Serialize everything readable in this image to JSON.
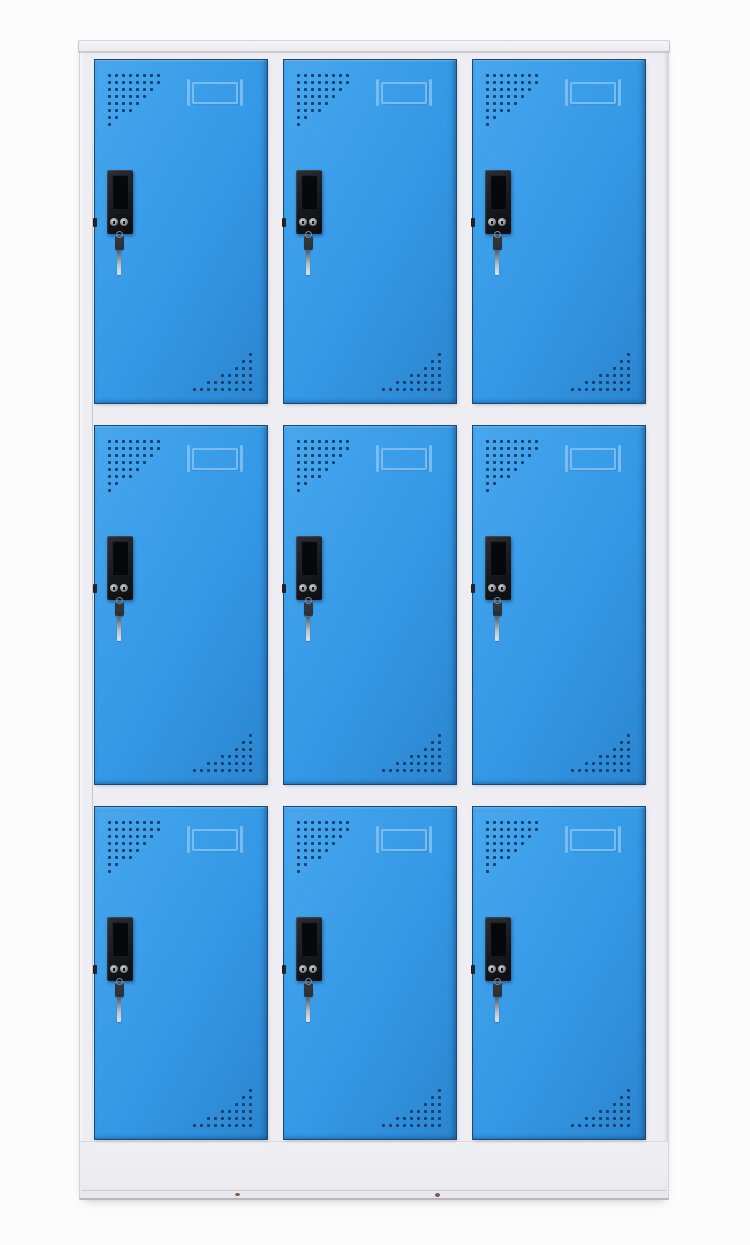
{
  "meta": {
    "subject": "Nine-door blue metal storage locker cabinet",
    "view": "front product photo on plain white background",
    "visible_text": "none"
  },
  "colors": {
    "background": "#fcfcfd",
    "frame_face": "#eeedf1",
    "frame_lip": "#f4f3f7",
    "frame_edge": "#b9b6bd",
    "frame_shadow": "#d6d4da",
    "door_blue_top": "#47a7ee",
    "door_blue": "#3498e6",
    "door_blue_deep": "#2b85cf",
    "door_border": "#16497c",
    "vent_dot": "#1a3f68",
    "emboss": "#aed6f5",
    "handle_black": "#17191d",
    "handle_recess": "#070809",
    "metal_light": "#c7cbd1",
    "metal_mid": "#878c93",
    "key_dark": "#2c2f34",
    "scuff": "#7c5a45"
  },
  "cabinet": {
    "rows": 3,
    "columns": 3,
    "door_count": 9,
    "vent_top_left_rows": [
      8,
      8,
      7,
      6,
      5,
      4,
      2,
      1
    ],
    "vent_bottom_right_rows": [
      1,
      2,
      3,
      5,
      7,
      9
    ],
    "door_features": [
      "perforated-vent-top-left",
      "embossed-label-card-holder",
      "black-recessed-handle",
      "cam-lock-with-hanging-keys",
      "perforated-vent-bottom-right"
    ],
    "base": "solid plinth with two small scuff marks near bottom edge"
  }
}
